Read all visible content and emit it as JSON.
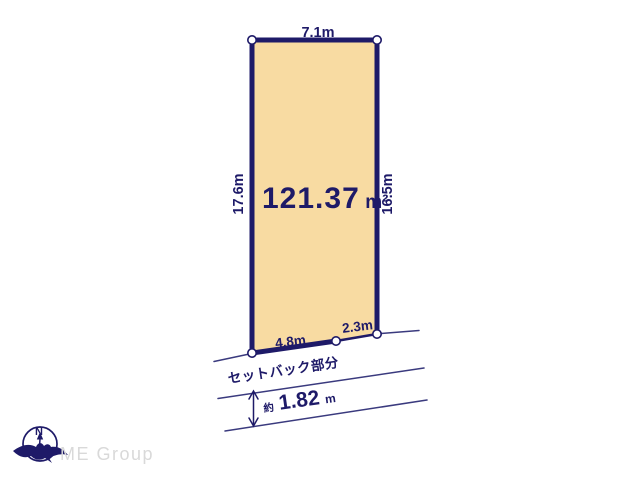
{
  "diagram": {
    "plot": {
      "area_value": "121.37",
      "area_unit": "m²",
      "top_width_label": "7.1m",
      "left_depth_label": "17.6m",
      "right_depth_label": "16.5m",
      "bottom_left_width_label": "4.8m",
      "bottom_right_width_label": "2.3m"
    },
    "setback": {
      "label": "セットバック部分",
      "approx_prefix": "約",
      "width_value": "1.82",
      "width_unit": "m"
    }
  },
  "logo": {
    "compass_north": "N",
    "company": "ME Group"
  },
  "colors": {
    "navy": "#1e1a68",
    "line": "#3a3a7e",
    "plot_fill": "#f8dba2",
    "logo_gray": "#d9d9d9",
    "background": "#ffffff"
  }
}
